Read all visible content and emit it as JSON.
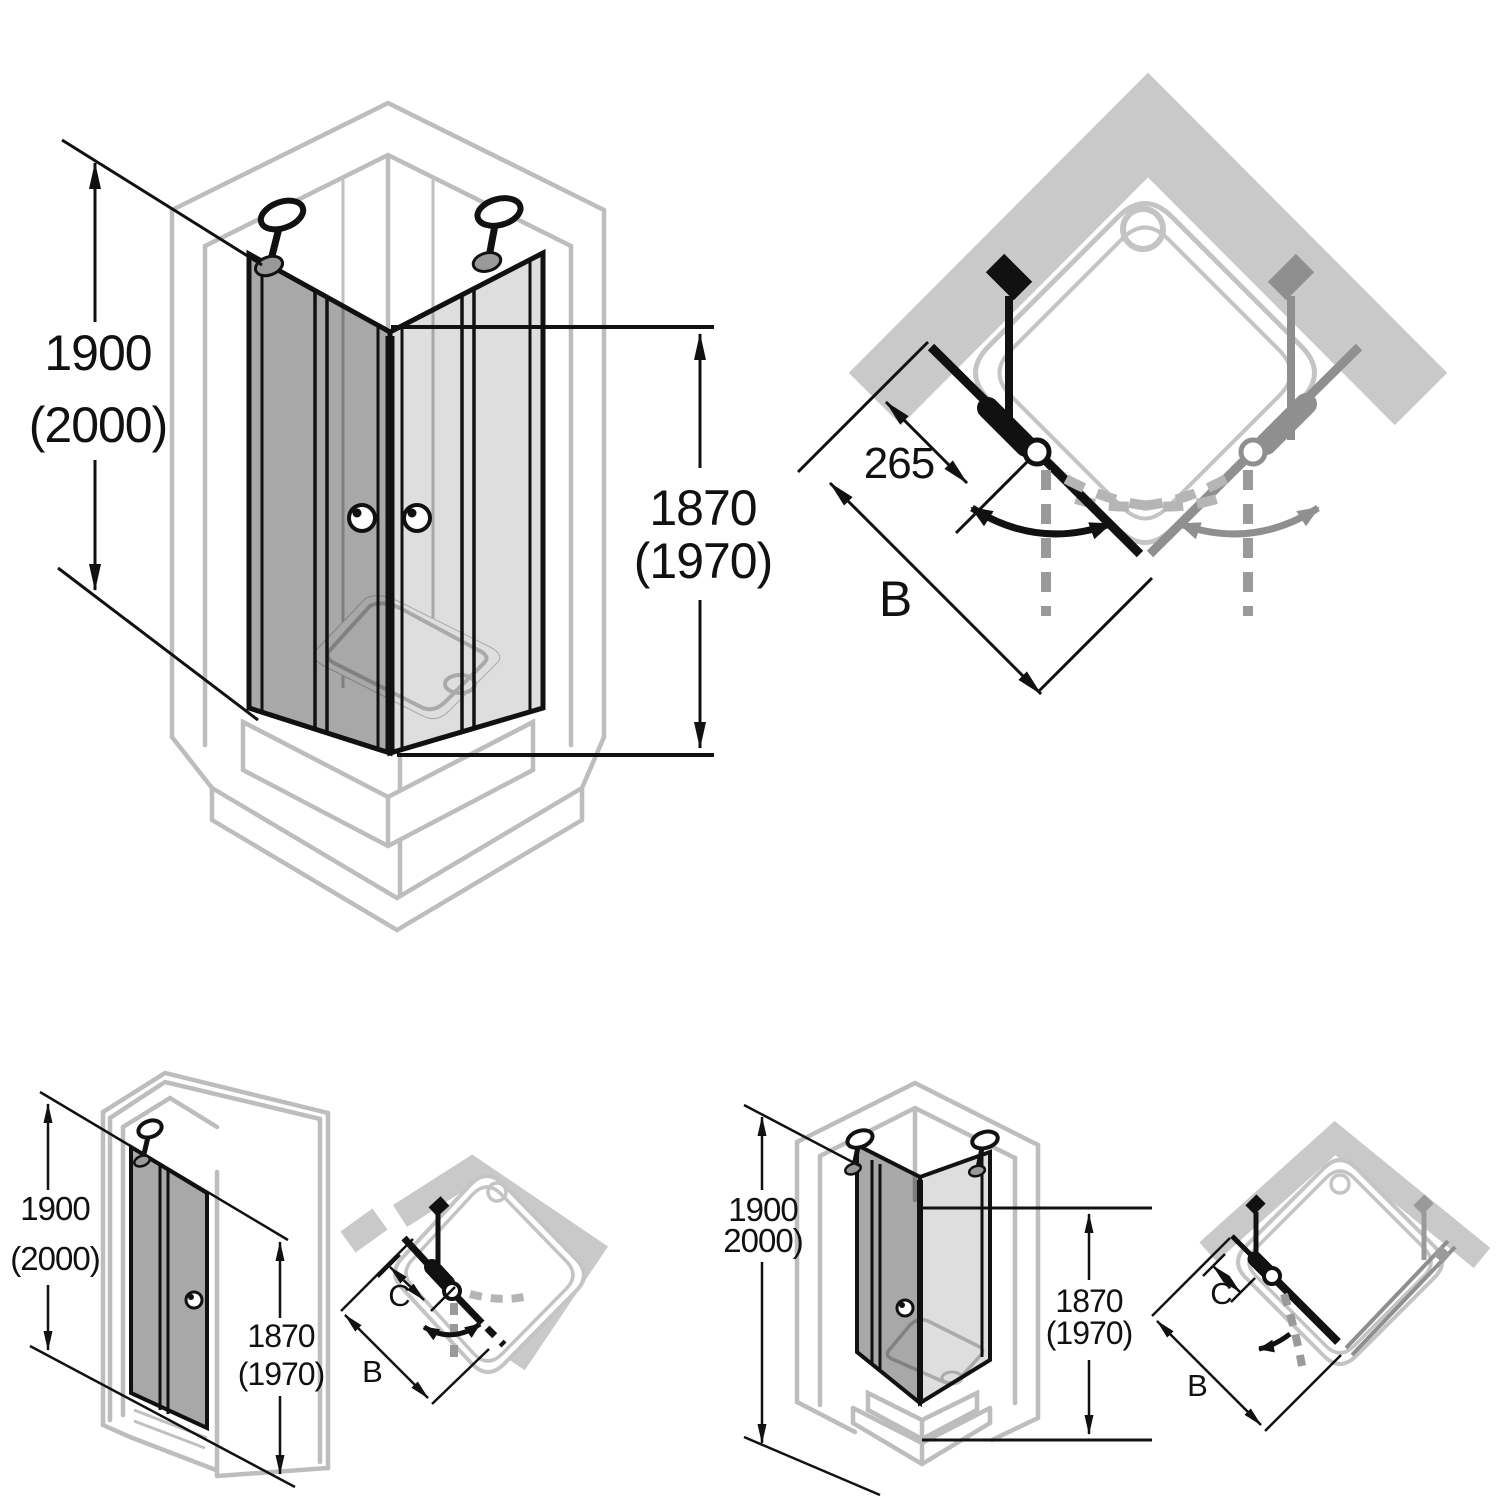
{
  "sheet": {
    "description": "Shower enclosure technical dimension diagrams, four views",
    "colors": {
      "background": "#ffffff",
      "line_black": "#111111",
      "wall_gray": "#c9c9c9",
      "outline_gray": "#bdbdbd",
      "dashed_gray": "#9a9a9a",
      "secondary_gray": "#8f8f8f"
    }
  },
  "diagrams": {
    "corner_entry_iso": {
      "dim_height_outer": [
        "1900",
        "(2000)"
      ],
      "dim_height_door": [
        "1870",
        "(1970)"
      ]
    },
    "corner_entry_plan": {
      "dim_fixed_segment": "265",
      "dim_width": "B"
    },
    "recess_iso": {
      "dim_height_outer": [
        "1900",
        "(2000)"
      ],
      "dim_height_door": [
        "1870",
        "(1970)"
      ]
    },
    "recess_plan": {
      "dim_fixed_segment": "C",
      "dim_width": "B"
    },
    "corner_side_iso": {
      "dim_height_outer": [
        "1900",
        "2000)"
      ],
      "dim_height_door": [
        "1870",
        "(1970)"
      ]
    },
    "corner_side_plan": {
      "dim_fixed_segment": "C",
      "dim_width": "B"
    }
  }
}
